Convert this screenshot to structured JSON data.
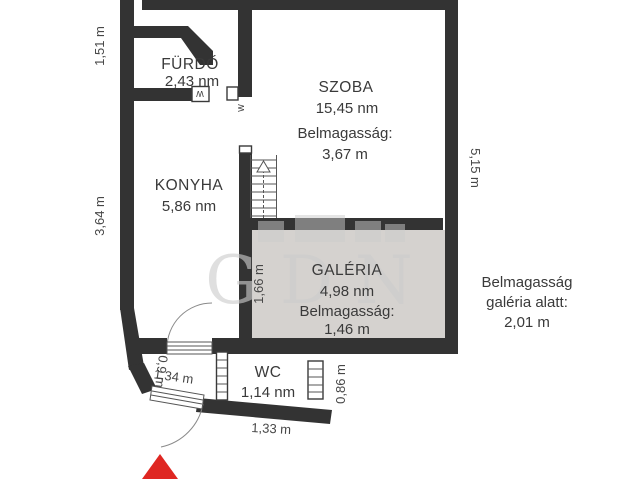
{
  "title": "Floor plan",
  "rooms": {
    "furdo": {
      "name": "FÜRDŐ",
      "area": "2,43 nm"
    },
    "szoba": {
      "name": "SZOBA",
      "area": "15,45 nm",
      "height_label": "Belmagasság:",
      "height": "3,67 m"
    },
    "konyha": {
      "name": "KONYHA",
      "area": "5,86 nm"
    },
    "galeria": {
      "name": "GALÉRIA",
      "area": "4,98 nm",
      "height_label": "Belmagasság:",
      "height": "1,46 m"
    },
    "wc": {
      "name": "WC",
      "area": "1,14 nm"
    }
  },
  "note": {
    "line1": "Belmagasság",
    "line2": "galéria alatt:",
    "line3": "2,01 m"
  },
  "dims": {
    "left_upper": "1,51 m",
    "left_lower": "3,64 m",
    "right_side": "5,15 m",
    "galeria_left": "1,66 m",
    "hall_width": "1,34 m",
    "hall_door": "0,9 m",
    "wc_right": "0,86 m",
    "wc_bottom": "1,33 m"
  },
  "door_marks": {
    "w1": "W",
    "w2": "W"
  },
  "watermark_text": "GDN",
  "colors": {
    "wall": "#333333",
    "galeria_fill": "#d5d2cf",
    "entrance_arrow": "#df2722",
    "watermark": "#cccccc"
  }
}
